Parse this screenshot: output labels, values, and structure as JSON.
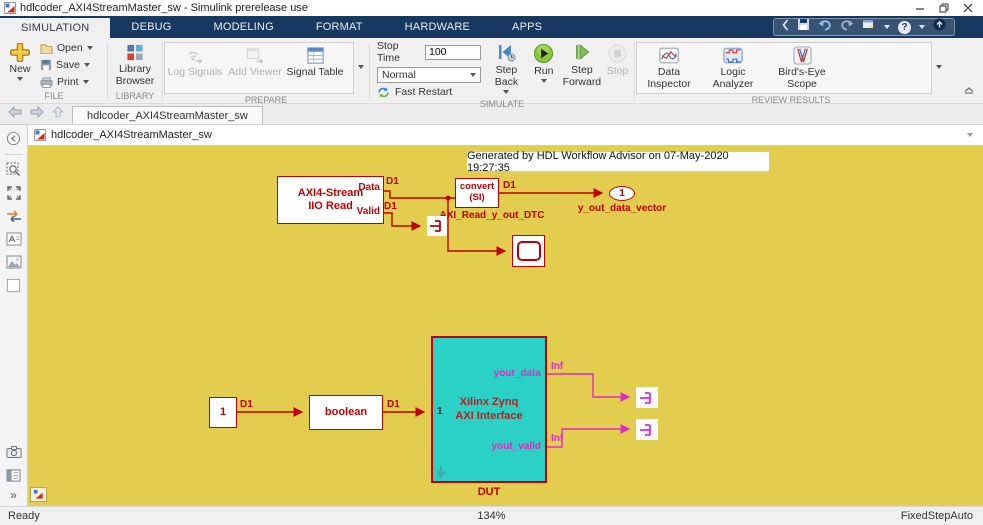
{
  "titlebar": {
    "title": "hdlcoder_AXI4StreamMaster_sw - Simulink prerelease use"
  },
  "ribbon_tabs": {
    "items": [
      {
        "label": "SIMULATION"
      },
      {
        "label": "DEBUG"
      },
      {
        "label": "MODELING"
      },
      {
        "label": "FORMAT"
      },
      {
        "label": "HARDWARE"
      },
      {
        "label": "APPS"
      }
    ]
  },
  "ribbon": {
    "file": {
      "new": "New",
      "open": "Open",
      "save": "Save",
      "print": "Print",
      "group": "FILE"
    },
    "library": {
      "browser": "Library Browser",
      "group": "LIBRARY"
    },
    "prepare": {
      "log_signals": "Log Signals",
      "add_viewer": "Add Viewer",
      "signal_table": "Signal Table",
      "group": "PREPARE"
    },
    "simulate": {
      "stop_time_label": "Stop Time",
      "stop_time_value": "100",
      "mode": "Normal",
      "fast_restart": "Fast Restart",
      "step_back": "Step Back",
      "run": "Run",
      "step_forward": "Step Forward",
      "stop": "Stop",
      "group": "SIMULATE"
    },
    "review": {
      "data_inspector": "Data Inspector",
      "logic_analyzer": "Logic Analyzer",
      "birdseye": "Bird's-Eye Scope",
      "group": "REVIEW RESULTS"
    }
  },
  "icons": {
    "help_glyph": "?",
    "more_glyph": "»"
  },
  "docbar": {
    "tab": "hdlcoder_AXI4StreamMaster_sw"
  },
  "breadcrumb": {
    "path": "hdlcoder_AXI4StreamMaster_sw"
  },
  "canvas": {
    "annotation": "Generated by HDL Workflow Advisor on 07-May-2020 19:27:35",
    "axi_block": {
      "line1": "AXI4-Stream",
      "line2": "IIO Read",
      "port_data": "Data",
      "port_valid": "Valid"
    },
    "convert_block": {
      "line1": "convert",
      "line2": "(SI)"
    },
    "outport": {
      "num": "1",
      "name": "y_out_data_vector"
    },
    "const_block": {
      "value": "1"
    },
    "boolean_block": {
      "label": "boolean"
    },
    "dut_block": {
      "port_in": "1",
      "line1": "Xilinx Zynq",
      "line2": "AXI Interface",
      "port_out1": "yout_data",
      "port_out2": "yout_valid",
      "caption": "DUT"
    },
    "labels": {
      "d1_data": "D1",
      "d1_valid": "D1",
      "d1_convert": "D1",
      "d1_const": "D1",
      "d1_bool": "D1",
      "dtc": "AXI_Read_y_out_DTC",
      "inf_top": "Inf",
      "inf_bottom": "Inf"
    }
  },
  "statusbar": {
    "state": "Ready",
    "zoom": "134%",
    "solver": "FixedStepAuto"
  },
  "colors": {
    "canvas": "#e3cd4e",
    "block_red": "#c00000",
    "dut_fill": "#2bd1c5",
    "magenta": "#e02cc4",
    "ribbon_blue": "#17395f"
  }
}
